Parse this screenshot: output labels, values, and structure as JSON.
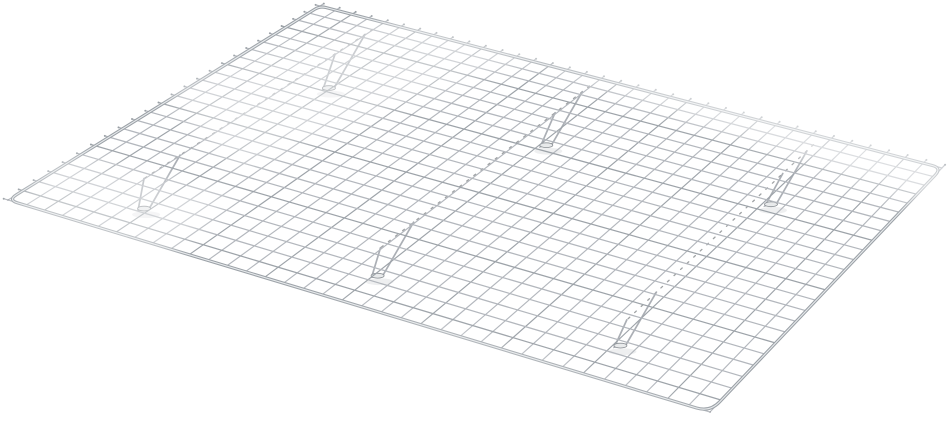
{
  "scene": {
    "description": "Product photo of a chrome-plated steel wire cooling rack (grid style with feet) on a seamless white background, viewed at a three-quarter perspective angle",
    "background_color": "#ffffff",
    "image_width": 948,
    "image_height": 422
  },
  "rack": {
    "corners": {
      "back_left": [
        320,
        6
      ],
      "back_right": [
        942,
        168
      ],
      "front_left": [
        8,
        200
      ],
      "front_right": [
        710,
        412
      ]
    },
    "corner_radii": [
      6,
      10,
      14,
      10
    ],
    "crosswire_count": 37,
    "longwire_count": 25,
    "tooth_length": 4.5,
    "wire_width": 1.15,
    "frame_width": 3.2,
    "colors": {
      "wire": "#b3b7bd",
      "wire_dark": "#9da3a9",
      "tooth": "#959ba1",
      "frame": "#9aa0a6",
      "frame_highlight": "#e7eaec",
      "joint": "#5f6367",
      "bar_glow": "#ffffff",
      "bar_dash": "#515559",
      "leg": "#a6abb1",
      "foot_fill": "#e8eaeb",
      "foot_edge": "#8b9095",
      "shadow": "#dadcde",
      "sheen": "#ffffff"
    },
    "support_bars": {
      "u_positions": [
        0.11,
        0.47,
        0.82
      ],
      "v_start": 0.04,
      "v_end": 0.82,
      "legs": {
        "attach_v": [
          0.07,
          0.7
        ],
        "arm_span_v": 0.11,
        "drop": [
          -30,
          52
        ],
        "foot_length": 12
      }
    },
    "sheen_bands": [
      {
        "points": "480,0 948,85 948,215 520,55",
        "opacity": 0.55
      },
      {
        "points": "160,85 430,8 570,42 235,170",
        "opacity": 0.4
      },
      {
        "points": "55,150 235,196 160,262 5,215",
        "opacity": 0.4
      },
      {
        "points": "30,245 440,330 725,422 60,422",
        "opacity": 0.45
      }
    ]
  }
}
